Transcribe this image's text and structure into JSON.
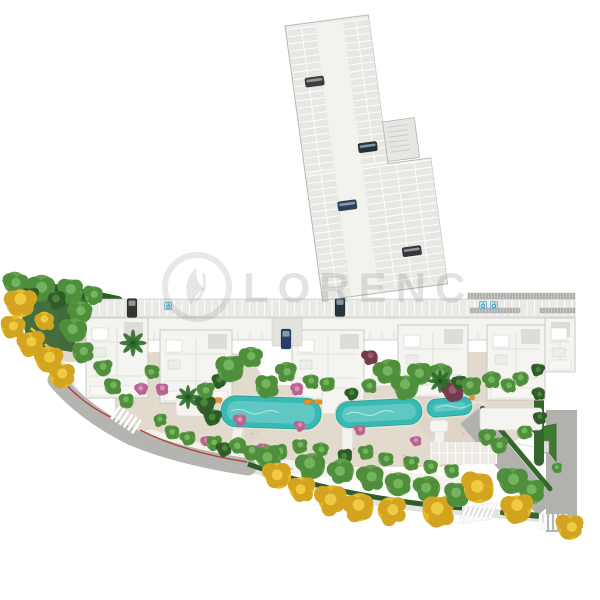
{
  "watermark": {
    "text": "LORENC",
    "logo": "phoenix-feather-icon"
  },
  "palette": {
    "pool": "#38b9b3",
    "pool_light": "#7fd6cf",
    "pool_edge": "#2aa09b",
    "gravel": "#ded4c5",
    "road": "#b4b4b0",
    "sidewalk": "#dcdcd8",
    "red_curb": "#b0453c",
    "hedge": "#35662c",
    "dark_bed": "#315f2b",
    "building": "#f4f4f1",
    "building_line": "#c6c6c1",
    "parking_bg": "#e8e8e5",
    "strip_bg": "#ececE9",
    "aisle": "#f2f2ef",
    "car_dark": "#3c3c3a",
    "accessible_blue": "#5aa8cc",
    "lounger_orange": "#e8912a",
    "island_green": "#3f7a33"
  },
  "tree_types": {
    "g": [
      "#4f8f3c",
      "#62a24d",
      "#74b45e"
    ],
    "d": [
      "#2f5c28",
      "#3c7330",
      "#49863a"
    ],
    "y": [
      "#d3a41f",
      "#e5ba2c",
      "#f0cb42"
    ],
    "p": [
      "#b96490",
      "#c97da2",
      "#d892b4"
    ],
    "m": [
      "#753a4d",
      "#8a4a5e",
      "#9c5c70"
    ]
  },
  "parking_structure": {
    "origin": {
      "x": 285,
      "y": 26
    },
    "angle_deg": -7.6,
    "outline": "M0,0 H84 V150 H127 V277 H1 Z",
    "aisle": {
      "x": 30,
      "y": 2,
      "w": 28,
      "h": 274
    },
    "upper_bands": [
      [
        2,
        30
      ],
      [
        58,
        84
      ]
    ],
    "upper_y": [
      4,
      148
    ],
    "lower_bands": [
      [
        2,
        30
      ],
      [
        58,
        127
      ]
    ],
    "lower_y": [
      152,
      274
    ],
    "stall_pitch": 7.2,
    "mid_lines_upper": [
      16,
      71
    ],
    "mid_lines_lower": [
      16,
      75,
      92,
      110
    ],
    "stair_core": {
      "x": 84,
      "y": 108,
      "w": 32,
      "h": 40
    },
    "cars": [
      {
        "x": 22,
        "y": 59,
        "color": "#3c3c3a"
      },
      {
        "x": 66,
        "y": 131,
        "color": "#203339"
      },
      {
        "x": 38,
        "y": 186,
        "color": "#2c3f5c"
      },
      {
        "x": 96,
        "y": 240,
        "color": "#35353a"
      }
    ]
  },
  "surface_parking_row": {
    "x1": 88,
    "x2": 575,
    "y": 299,
    "h": 18,
    "stall_pitch": 7.5,
    "cars": [
      {
        "x": 132,
        "y": 308,
        "color": "#34342f"
      },
      {
        "x": 340,
        "y": 307,
        "color": "#24363e"
      }
    ],
    "accessible_spots": [
      {
        "x": 168,
        "y": 306
      },
      {
        "x": 483,
        "y": 305
      },
      {
        "x": 494,
        "y": 305
      }
    ],
    "vent_hatches": [
      {
        "x": 468,
        "y": 293,
        "w": 107,
        "h": 6
      },
      {
        "x": 470,
        "y": 308,
        "w": 50,
        "h": 5
      },
      {
        "x": 540,
        "y": 308,
        "w": 35,
        "h": 5
      }
    ]
  },
  "building": {
    "slab": {
      "x": 86,
      "y": 318,
      "w": 489,
      "h": 22
    },
    "wings": [
      {
        "x": 86,
        "y": 318,
        "w": 62,
        "h": 80
      },
      {
        "x": 160,
        "y": 330,
        "w": 72,
        "h": 73
      },
      {
        "x": 292,
        "y": 330,
        "w": 72,
        "h": 70
      },
      {
        "x": 398,
        "y": 325,
        "w": 70,
        "h": 72
      },
      {
        "x": 487,
        "y": 325,
        "w": 58,
        "h": 75
      },
      {
        "x": 545,
        "y": 318,
        "w": 30,
        "h": 54
      }
    ],
    "pads": [
      {
        "x": 176,
        "y": 394,
        "w": 36,
        "h": 22
      },
      {
        "x": 322,
        "y": 388,
        "w": 32,
        "h": 26
      },
      {
        "x": 372,
        "y": 372,
        "w": 20,
        "h": 14
      },
      {
        "x": 430,
        "y": 420,
        "w": 18,
        "h": 12
      },
      {
        "x": 480,
        "y": 408,
        "w": 62,
        "h": 22
      }
    ],
    "driveway": {
      "x": 272,
      "y": 318,
      "w": 30,
      "h": 28,
      "car": {
        "x": 286,
        "y": 339,
        "color": "#27406b"
      }
    },
    "forecourt_stalls": {
      "x": 431,
      "y": 442,
      "w": 66,
      "h": 22,
      "pitch": 8.2
    }
  },
  "pools": [
    {
      "x": 221,
      "y": 397,
      "w": 100,
      "h": 31,
      "rx": 15,
      "a": 2
    },
    {
      "x": 336,
      "y": 400,
      "w": 86,
      "h": 26,
      "rx": 13,
      "a": -3
    },
    {
      "x": 427,
      "y": 398,
      "w": 45,
      "h": 18,
      "rx": 9,
      "a": -5
    }
  ],
  "loungers": [
    {
      "x": 213,
      "y": 400,
      "a": 0
    },
    {
      "x": 313,
      "y": 402,
      "a": 0
    },
    {
      "x": 472,
      "y": 391,
      "a": 90
    }
  ],
  "crosswalks": [
    {
      "cx": 127,
      "cy": 420,
      "angle": 34,
      "stripes": 6,
      "skew": 0
    },
    {
      "cx": 479,
      "cy": 513,
      "angle": -8,
      "stripes": 7,
      "skew": -32
    },
    {
      "cx": 554,
      "cy": 522,
      "angle": 0,
      "stripes": 6,
      "skew": 0
    }
  ],
  "benches": [
    {
      "x": 33,
      "y": 330,
      "a": 40
    },
    {
      "x": 47,
      "y": 346,
      "a": 40
    }
  ],
  "palms": [
    {
      "x": 133,
      "y": 343,
      "r": 9
    },
    {
      "x": 188,
      "y": 397,
      "r": 8
    },
    {
      "x": 440,
      "y": 381,
      "r": 8
    }
  ],
  "trees": [
    [
      "g",
      16,
      284,
      11
    ],
    [
      "g",
      42,
      288,
      13
    ],
    [
      "g",
      70,
      291,
      12
    ],
    [
      "g",
      94,
      295,
      9
    ],
    [
      "d",
      30,
      296,
      8
    ],
    [
      "d",
      57,
      300,
      9
    ],
    [
      "g",
      80,
      312,
      11
    ],
    [
      "g",
      74,
      331,
      12
    ],
    [
      "g",
      83,
      352,
      10
    ],
    [
      "g",
      103,
      368,
      8
    ],
    [
      "g",
      113,
      386,
      8
    ],
    [
      "p",
      141,
      389,
      6
    ],
    [
      "g",
      126,
      401,
      7
    ],
    [
      "y",
      21,
      302,
      14
    ],
    [
      "y",
      13,
      327,
      11
    ],
    [
      "y",
      31,
      343,
      12
    ],
    [
      "y",
      49,
      359,
      13
    ],
    [
      "y",
      63,
      375,
      12
    ],
    [
      "y",
      45,
      321,
      9
    ],
    [
      "g",
      152,
      372,
      7
    ],
    [
      "p",
      162,
      389,
      6
    ],
    [
      "d",
      205,
      404,
      9
    ],
    [
      "d",
      213,
      417,
      8
    ],
    [
      "g",
      206,
      391,
      8
    ],
    [
      "d",
      219,
      381,
      7
    ],
    [
      "g",
      230,
      368,
      13
    ],
    [
      "g",
      251,
      357,
      10
    ],
    [
      "g",
      267,
      386,
      11
    ],
    [
      "g",
      286,
      372,
      9
    ],
    [
      "p",
      297,
      389,
      6
    ],
    [
      "g",
      311,
      382,
      7
    ],
    [
      "g",
      327,
      384,
      7
    ],
    [
      "d",
      352,
      394,
      6
    ],
    [
      "g",
      369,
      386,
      7
    ],
    [
      "m",
      370,
      357,
      7
    ],
    [
      "g",
      388,
      372,
      12
    ],
    [
      "g",
      405,
      387,
      12
    ],
    [
      "g",
      419,
      373,
      11
    ],
    [
      "g",
      441,
      374,
      10
    ],
    [
      "m",
      453,
      391,
      10
    ],
    [
      "d",
      459,
      383,
      7
    ],
    [
      "g",
      471,
      386,
      9
    ],
    [
      "g",
      492,
      380,
      8
    ],
    [
      "g",
      509,
      386,
      7
    ],
    [
      "g",
      521,
      379,
      7
    ],
    [
      "p",
      240,
      420,
      6
    ],
    [
      "p",
      300,
      426,
      5
    ],
    [
      "p",
      360,
      430,
      5
    ],
    [
      "p",
      416,
      441,
      5
    ],
    [
      "g",
      160,
      420,
      6
    ],
    [
      "g",
      172,
      432,
      7
    ],
    [
      "g",
      188,
      438,
      7
    ],
    [
      "p",
      206,
      441,
      5
    ],
    [
      "g",
      214,
      443,
      7
    ],
    [
      "d",
      224,
      449,
      7
    ],
    [
      "g",
      238,
      446,
      8
    ],
    [
      "g",
      252,
      452,
      8
    ],
    [
      "p",
      263,
      448,
      5
    ],
    [
      "g",
      279,
      452,
      8
    ],
    [
      "g",
      300,
      446,
      7
    ],
    [
      "g",
      321,
      450,
      7
    ],
    [
      "d",
      345,
      456,
      7
    ],
    [
      "g",
      366,
      452,
      7
    ],
    [
      "g",
      386,
      459,
      7
    ],
    [
      "g",
      411,
      463,
      7
    ],
    [
      "g",
      431,
      467,
      7
    ],
    [
      "g",
      452,
      471,
      7
    ],
    [
      "g",
      487,
      437,
      8
    ],
    [
      "g",
      499,
      445,
      8
    ],
    [
      "g",
      268,
      458,
      12
    ],
    [
      "y",
      277,
      475,
      13
    ],
    [
      "g",
      311,
      466,
      13
    ],
    [
      "y",
      301,
      490,
      12
    ],
    [
      "g",
      341,
      472,
      12
    ],
    [
      "y",
      332,
      500,
      14
    ],
    [
      "g",
      371,
      478,
      12
    ],
    [
      "y",
      358,
      507,
      14
    ],
    [
      "g",
      399,
      484,
      12
    ],
    [
      "y",
      392,
      511,
      13
    ],
    [
      "g",
      427,
      489,
      12
    ],
    [
      "y",
      439,
      512,
      15
    ],
    [
      "g",
      457,
      494,
      12
    ],
    [
      "y",
      478,
      487,
      15
    ],
    [
      "g",
      513,
      480,
      13
    ],
    [
      "g",
      531,
      491,
      12
    ],
    [
      "y",
      517,
      508,
      14
    ],
    [
      "y",
      571,
      527,
      12
    ],
    [
      "d",
      538,
      370,
      6
    ],
    [
      "d",
      539,
      394,
      6
    ],
    [
      "d",
      540,
      418,
      6
    ],
    [
      "g",
      525,
      432,
      7
    ],
    [
      "g",
      557,
      468,
      5
    ]
  ]
}
